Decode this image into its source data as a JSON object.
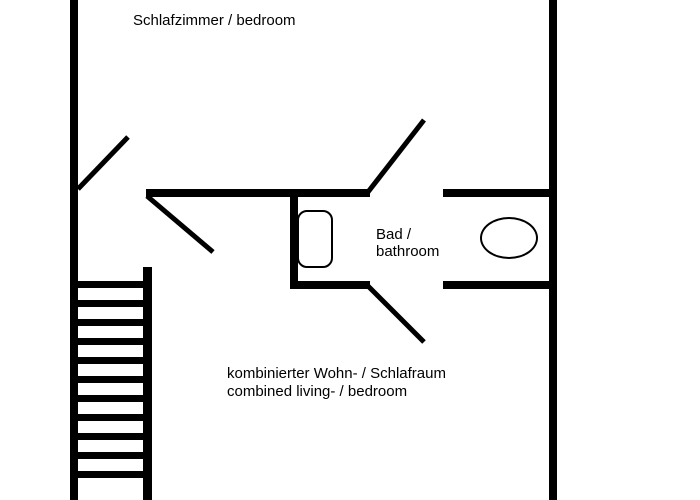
{
  "labels": {
    "bedroom": "Schlafzimmer / bedroom",
    "bathroom_line1": "Bad /",
    "bathroom_line2": "bathroom",
    "living_line1": "kombinierter Wohn- / Schlafraum",
    "living_line2": "combined living- / bedroom"
  },
  "colors": {
    "wall": "#000000",
    "background": "#ffffff",
    "text": "#000000"
  },
  "geometry": {
    "walls": [
      {
        "name": "left-outer-wall",
        "x": 70,
        "y": 0,
        "w": 8,
        "h": 500
      },
      {
        "name": "right-outer-wall",
        "x": 549,
        "y": 0,
        "w": 8,
        "h": 500
      },
      {
        "name": "partition-wall",
        "x": 146,
        "y": 189,
        "w": 224,
        "h": 8
      },
      {
        "name": "bathroom-right-top-wall",
        "x": 443,
        "y": 189,
        "w": 106,
        "h": 8
      },
      {
        "name": "bathroom-left-wall",
        "x": 290,
        "y": 197,
        "w": 8,
        "h": 91
      },
      {
        "name": "bathroom-bottom-wall",
        "x": 290,
        "y": 281,
        "w": 80,
        "h": 8
      },
      {
        "name": "living-right-bottom-wall",
        "x": 443,
        "y": 281,
        "w": 106,
        "h": 8
      },
      {
        "name": "stair-side-wall",
        "x": 143,
        "y": 267,
        "w": 9,
        "h": 233
      }
    ],
    "door_swings": [
      {
        "name": "bedroom-door-swing",
        "x1": 78,
        "y1": 189,
        "x2": 128,
        "y2": 137
      },
      {
        "name": "living-door-swing",
        "x1": 147,
        "y1": 196,
        "x2": 213,
        "y2": 252
      },
      {
        "name": "bathroom-top-door-swing",
        "x1": 368,
        "y1": 192,
        "x2": 424,
        "y2": 120
      },
      {
        "name": "bathroom-bottom-door-swing",
        "x1": 368,
        "y1": 286,
        "x2": 424,
        "y2": 342
      }
    ],
    "stairs": {
      "tread_x": 78,
      "tread_width": 74,
      "first_tread_y": 281,
      "tread_count": 11,
      "tread_spacing": 19,
      "tread_thickness": 7
    },
    "line_weights": {
      "door_swing_stroke": 5
    }
  },
  "fixtures": {
    "toilet": "toilet",
    "washbasin": "washbasin"
  }
}
